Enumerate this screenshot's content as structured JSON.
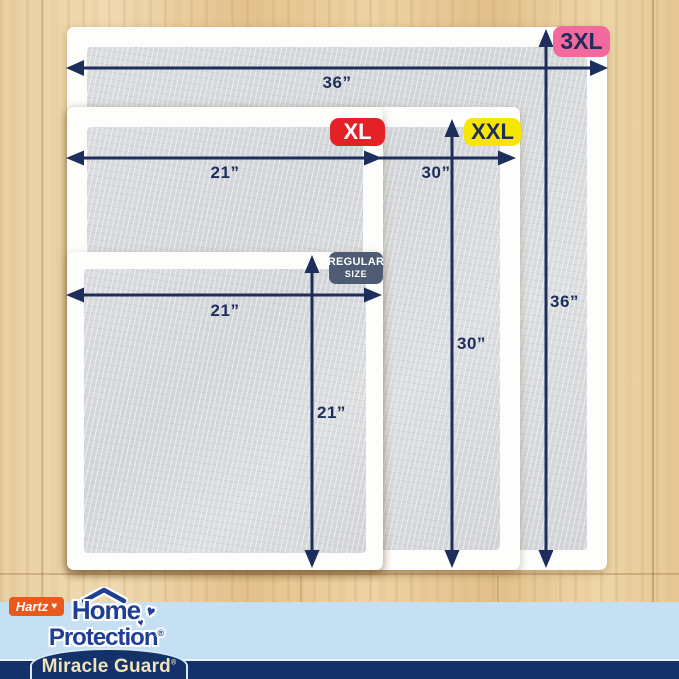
{
  "sizes": {
    "regular": {
      "badge_line1": "REGULAR",
      "badge_line2": "SIZE",
      "width_label": "21”",
      "height_label": "21”",
      "badge_bg": "#4d5c72",
      "badge_fg": "#ffffff"
    },
    "xl": {
      "badge": "XL",
      "width_label": "21”",
      "badge_bg": "#e32127",
      "badge_fg": "#ffffff"
    },
    "xxl": {
      "badge": "XXL",
      "width_label": "30”",
      "height_label": "30”",
      "badge_bg": "#f7e600",
      "badge_fg": "#1d2e5c"
    },
    "xxxl": {
      "badge": "3XL",
      "width_label": "36”",
      "height_label": "36”",
      "badge_bg": "#f2699e",
      "badge_fg": "#1d2e5c"
    }
  },
  "brand": {
    "hartz": "Hartz",
    "heart": "♥",
    "home": "Home",
    "protection": "Protection",
    "registered": "®",
    "product": "Miracle Guard"
  },
  "colors": {
    "arrow_navy": "#1d2e5c",
    "wood_base": "#e8cb9c",
    "pad_gray": "#d6d8db",
    "pad_white": "#fdfdfc",
    "band_light_blue": "#c5e0f2",
    "band_navy": "#123269",
    "hartz_orange": "#e9591b",
    "logo_blue": "#1f3f94",
    "miracle_guard_text": "#f2e2b6"
  }
}
